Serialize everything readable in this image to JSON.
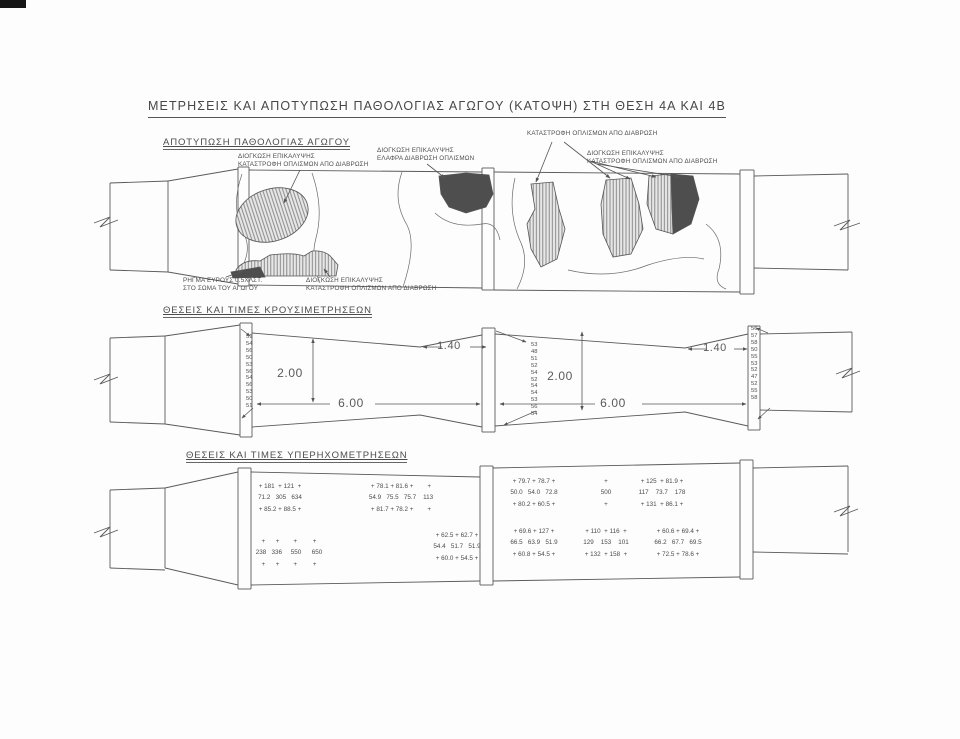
{
  "title": "ΜΕΤΡΗΣΕΙΣ ΚΑΙ ΑΠΟΤΥΠΩΣΗ ΠΑΘΟΛΟΓΙΑΣ ΑΓΩΓΟΥ (ΚΑΤΟΨΗ) ΣΤΗ ΘΕΣΗ 4Α ΚΑΙ 4Β",
  "colors": {
    "line": "#5a5a5a",
    "dark_damage_fill": "#4e4e4e",
    "hatch_line": "#808080",
    "paper": "#fdfdfd"
  },
  "pathology": {
    "heading": "ΑΠΟΤΥΠΩΣΗ ΠΑΘΟΛΟΓΙΑΣ ΑΓΩΓΟΥ",
    "annotations": {
      "cover_swelling_rebar_destruction": [
        "ΔΙΟΓΚΩΣΗ ΕΠΙΚΑΛΥΨΗΣ",
        "ΚΑΤΑΣΤΡΟΦΗ ΟΠΛΙΣΜΩΝ ΑΠΟ ΔΙΑΒΡΩΣΗ"
      ],
      "cover_swelling_light_corrosion": [
        "ΔΙΟΓΚΩΣΗ ΕΠΙΚΑΛΥΨΗΣ",
        "ΕΛΑΦΡΑ ΔΙΑΒΡΩΣΗ ΟΠΛΙΣΜΩΝ"
      ],
      "rebar_destruction": "ΚΑΤΑΣΤΡΟΦΗ ΟΠΛΙΣΜΩΝ ΑΠΟ ΔΙΑΒΡΩΣΗ",
      "crack": [
        "ΡΗΓΜΑ ΕΥΡΟΥΣ 0.5ΧΛΣΤ.",
        "ΣΤΟ ΣΩΜΑ ΤΟΥ ΑΓΩΓΟΥ"
      ]
    }
  },
  "rebound": {
    "heading": "ΘΕΣΕΙΣ ΚΑΙ ΤΙΜΕΣ ΚΡΟΥΣΙΜΕΤΡΗΣΕΩΝ",
    "dims": {
      "width": "2.00",
      "length": "6.00",
      "taper": "1.40"
    },
    "columns": {
      "left": [
        "51",
        "54",
        "56",
        "50",
        "53",
        "56",
        "54",
        "56",
        "53",
        "50",
        "51"
      ],
      "middle": [
        "53",
        "48",
        "51",
        "52",
        "54",
        "52",
        "54",
        "54",
        "53",
        "56",
        "54"
      ],
      "right": [
        "56",
        "57",
        "58",
        "50",
        "55",
        "53",
        "52",
        "47",
        "52",
        "55",
        "58"
      ]
    }
  },
  "ultrasonic": {
    "heading": "ΘΕΣΕΙΣ ΚΑΙ ΤΙΜΕΣ ΥΠΕΡΗΧΟΜΕΤΡΗΣΕΩΝ",
    "groups": {
      "g1": [
        "+ 181  + 121  +",
        "71.2   305   634",
        "+ 85.2 + 88.5 +"
      ],
      "g2": [
        "+ 78.1 + 81.6 +        +",
        "54.9   75.5   75.7    113",
        "+ 81.7 + 78.2 +        +"
      ],
      "g3": [
        "+      +        +         +",
        "238   336     550      650",
        "+      +        +         +"
      ],
      "g4": [
        "+ 62.5 + 62.7 +",
        "54.4   51.7   51.9",
        "+ 60.0 + 54.5 +"
      ],
      "g5": [
        "+ 79.7 + 78.7 +",
        "50.0   54.0   72.8",
        "+ 80.2 + 60.5 +"
      ],
      "g6": [
        "+",
        "500",
        "+"
      ],
      "g7": [
        "+ 125  + 81.9 +",
        "117    73.7    178",
        "+ 131  + 86.1 +"
      ],
      "g8": [
        "+ 69.6 + 127 +",
        "66.5   63.9   51.9",
        "+ 60.8 + 54.5 +"
      ],
      "g9": [
        "+ 110  + 116  +",
        "129    153    101",
        "+ 132  + 158  +"
      ],
      "g10": [
        "+ 60.6 + 69.4 +",
        "66.2   67.7   69.5",
        "+ 72.5 + 78.6 +"
      ]
    }
  }
}
